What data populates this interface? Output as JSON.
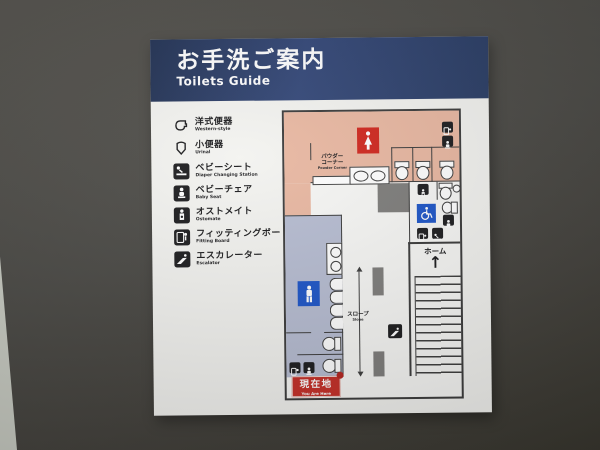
{
  "header": {
    "title_jp": "お手洗ご案内",
    "title_en": "Toilets Guide"
  },
  "legend": {
    "items": [
      {
        "jp": "洋式便器",
        "en": "Western-style",
        "icon": "western-toilet-icon"
      },
      {
        "jp": "小便器",
        "en": "Urinal",
        "icon": "urinal-icon"
      },
      {
        "jp": "ベビーシート",
        "en": "Diaper Changing Station",
        "icon": "diaper-station-icon"
      },
      {
        "jp": "ベビーチェア",
        "en": "Baby Seat",
        "icon": "baby-seat-icon"
      },
      {
        "jp": "オストメイト",
        "en": "Ostomate",
        "icon": "ostomate-icon"
      },
      {
        "jp": "フィッティングボード",
        "en": "Fitting Board",
        "icon": "fitting-board-icon"
      },
      {
        "jp": "エスカレーター",
        "en": "Escalator",
        "icon": "escalator-icon"
      }
    ]
  },
  "map": {
    "powder_corner_jp_line1": "パウダー",
    "powder_corner_jp_line2": "コーナー",
    "powder_corner_en": "Powder Corner",
    "home_label": "ホーム",
    "home_arrow": "↑",
    "slope_jp": "スロープ",
    "slope_en": "Slope",
    "you_are_here_jp": "現在地",
    "you_are_here_en": "You Are Here"
  },
  "colors": {
    "header_navy": "#2c3f68",
    "women_area_pink": "#e9b8a2",
    "men_area_lavender": "#b7bdd2",
    "women_sign_red": "#d0281f",
    "men_sign_blue": "#1e56c8",
    "accessible_sign_blue": "#1e56c8",
    "you_are_here_red": "#c62f28",
    "pillar_gray": "#7f7e7c",
    "wall_line": "#3e3e3e",
    "wall_background": "#4c4b47",
    "sign_white": "#f3f3f0"
  }
}
